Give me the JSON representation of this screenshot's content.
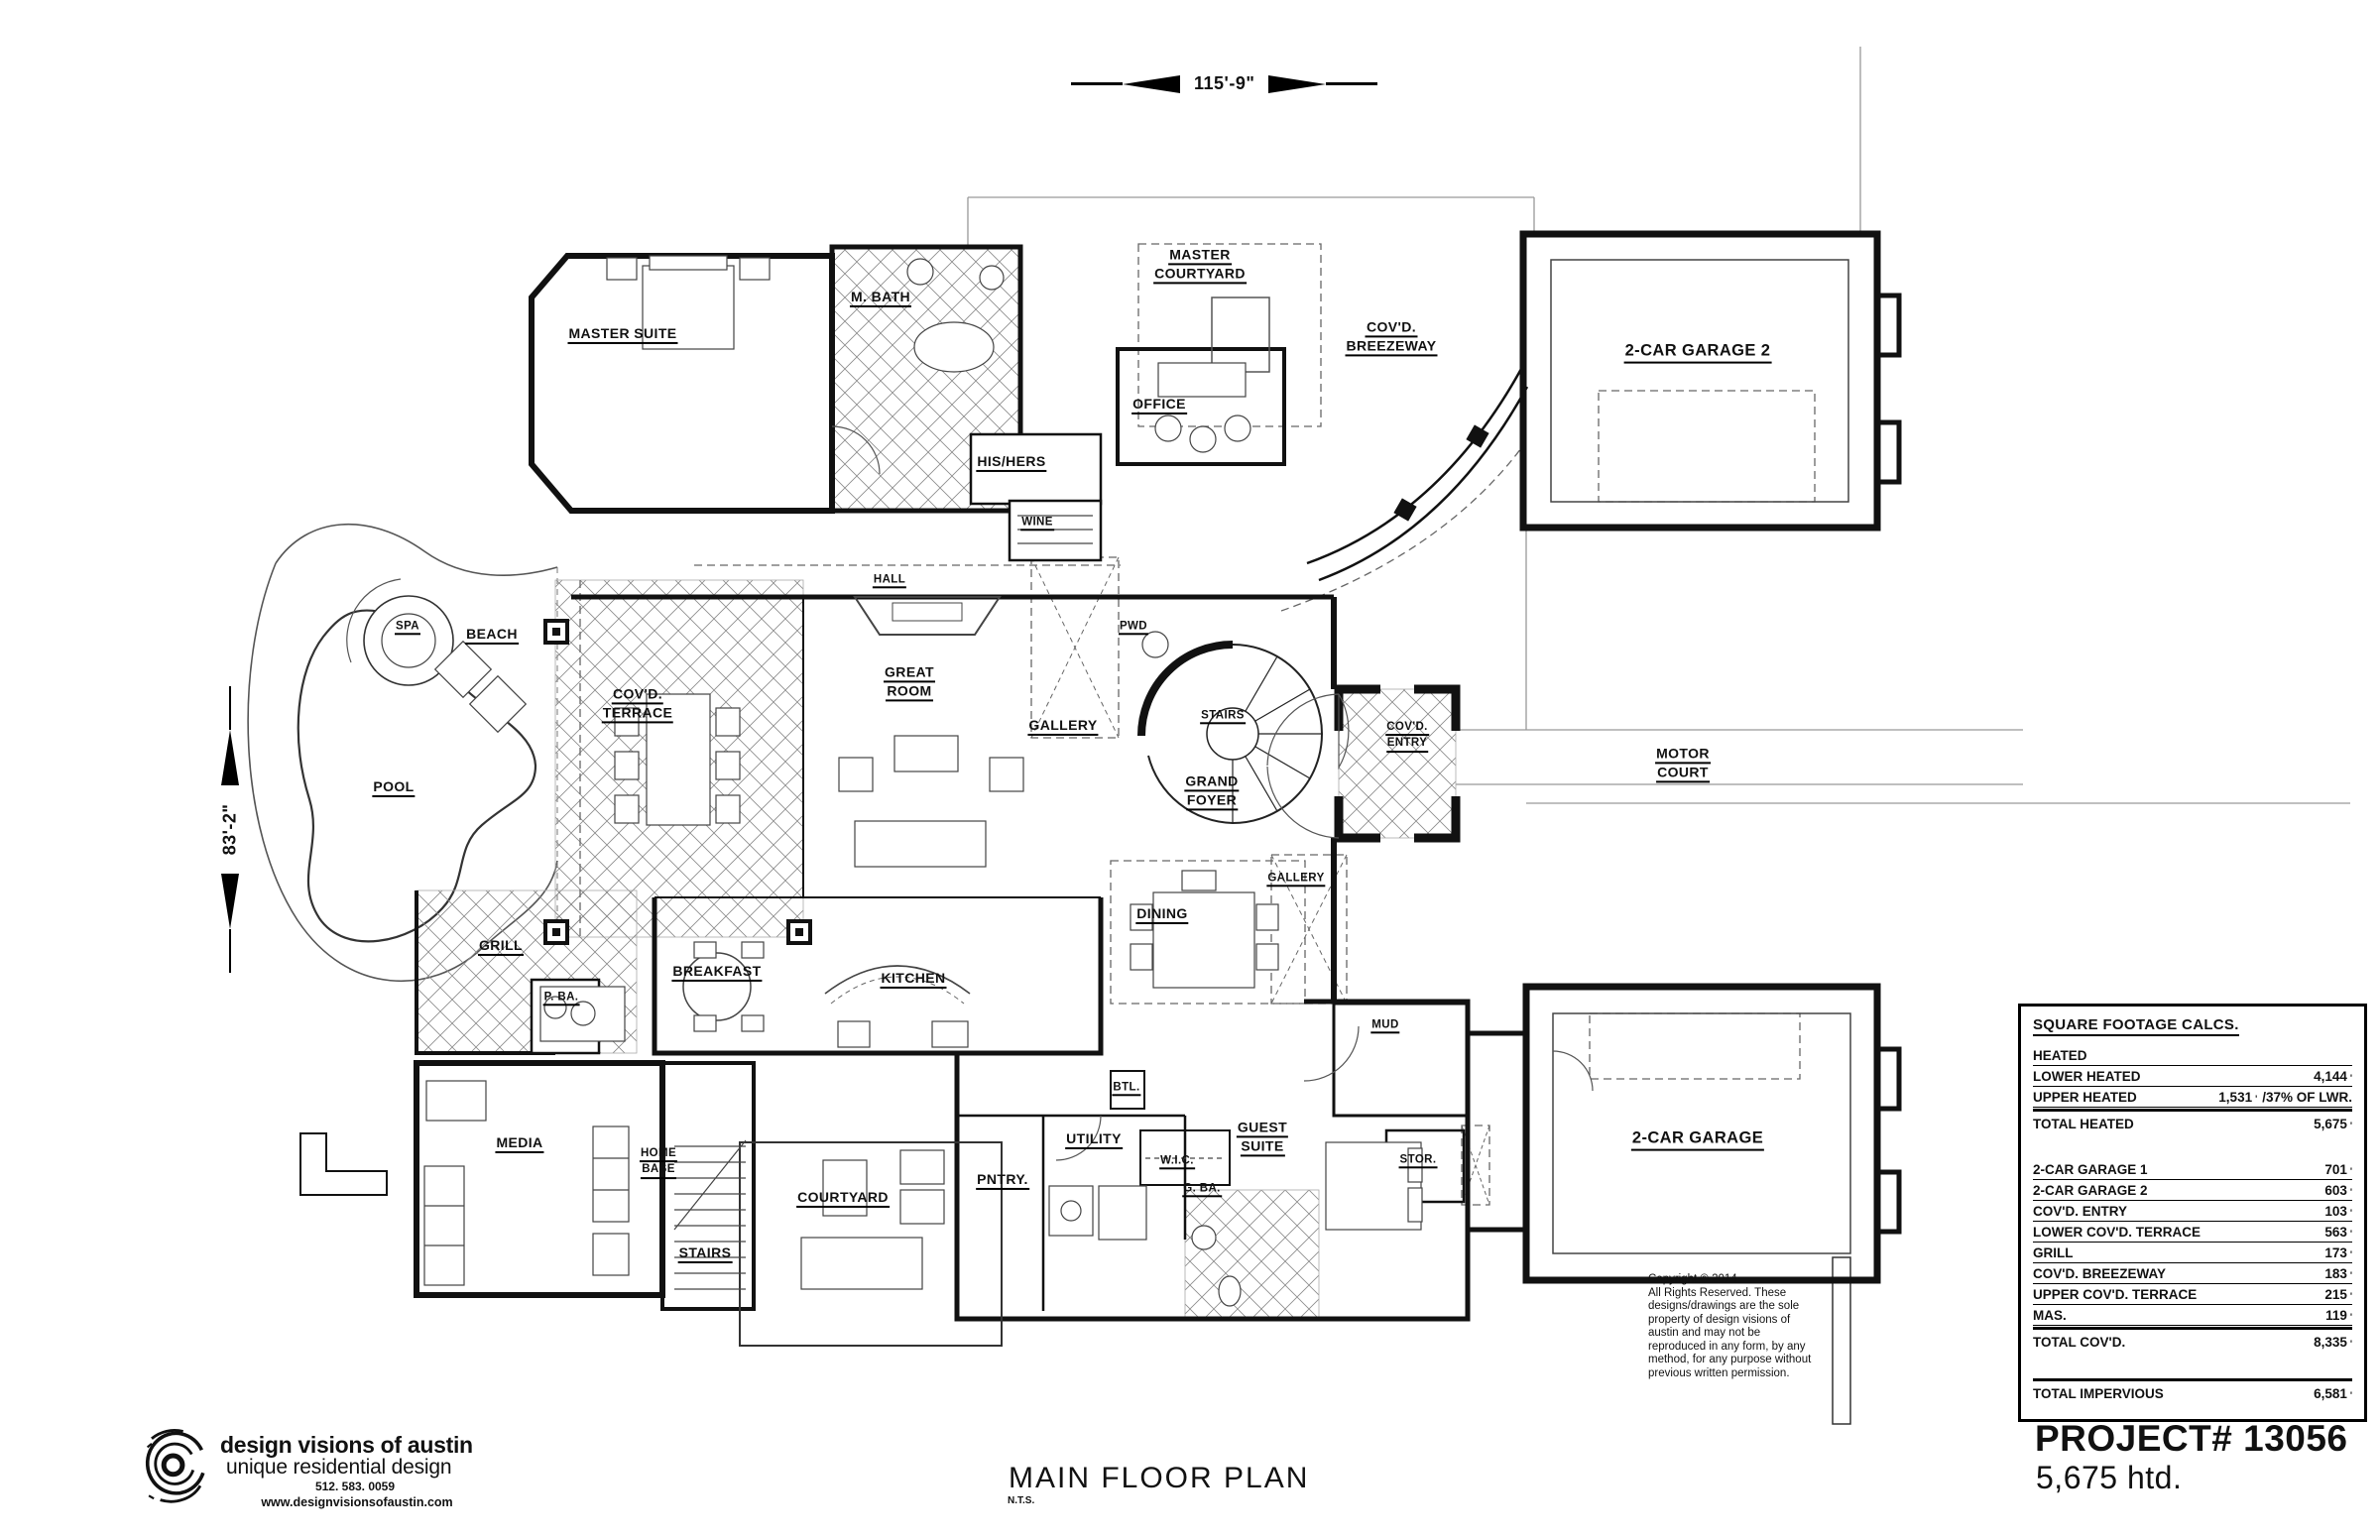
{
  "dimensions": {
    "width_label": "115'-9\"",
    "height_label": "83'-2\""
  },
  "title_block": {
    "title": "MAIN FLOOR PLAN",
    "scale_note": "N.T.S."
  },
  "project": {
    "number_label": "PROJECT# 13056",
    "area_label": "5,675 htd."
  },
  "firm": {
    "logo_icon": "swirl-logo",
    "name": "design visions of austin",
    "tagline": "unique residential design",
    "phone": "512. 583. 0059",
    "website": "www.designvisionsofaustin.com"
  },
  "copyright": {
    "text": "Copyright  ©  2014\nAll Rights Reserved. These\ndesigns/drawings are the sole\nproperty of design visions of\naustin and may not be\nreproduced in any form, by any\nmethod, for any purpose without\nprevious written permission."
  },
  "sqft_table": {
    "title": "SQUARE FOOTAGE CALCS.",
    "section_heated_label": "HEATED",
    "rows_heated": [
      {
        "label": "LOWER HEATED",
        "value": "4,144",
        "unit": "'"
      },
      {
        "label": "UPPER HEATED",
        "value": "1,531",
        "unit": "'",
        "note": "/37% OF LWR."
      }
    ],
    "total_heated": {
      "label": "TOTAL HEATED",
      "value": "5,675",
      "unit": "'"
    },
    "rows_covered": [
      {
        "label": "2-CAR GARAGE 1",
        "value": "701",
        "unit": "'"
      },
      {
        "label": "2-CAR GARAGE 2",
        "value": "603",
        "unit": "'"
      },
      {
        "label": "COV'D. ENTRY",
        "value": "103",
        "unit": "'"
      },
      {
        "label": "LOWER COV'D. TERRACE",
        "value": "563",
        "unit": "'"
      },
      {
        "label": "GRILL",
        "value": "173",
        "unit": "'"
      },
      {
        "label": "COV'D. BREEZEWAY",
        "value": "183",
        "unit": "'"
      },
      {
        "label": "UPPER COV'D. TERRACE",
        "value": "215",
        "unit": "'"
      },
      {
        "label": "MAS.",
        "value": "119",
        "unit": "'"
      }
    ],
    "total_covered": {
      "label": "TOTAL COV'D.",
      "value": "8,335",
      "unit": "'"
    },
    "total_impervious": {
      "label": "TOTAL IMPERVIOUS",
      "value": "6,581",
      "unit": "'"
    }
  },
  "rooms": [
    {
      "id": "master-suite",
      "lines": [
        "MASTER SUITE"
      ]
    },
    {
      "id": "m-bath",
      "lines": [
        "M. BATH"
      ]
    },
    {
      "id": "his-hers",
      "lines": [
        "HIS/HERS"
      ]
    },
    {
      "id": "wine",
      "lines": [
        "WINE"
      ]
    },
    {
      "id": "office",
      "lines": [
        "OFFICE"
      ]
    },
    {
      "id": "master-courtyard",
      "lines": [
        "MASTER",
        "COURTYARD"
      ]
    },
    {
      "id": "covd-breezeway",
      "lines": [
        "COV'D.",
        "BREEZEWAY"
      ]
    },
    {
      "id": "garage-2",
      "lines": [
        "2-CAR GARAGE 2"
      ]
    },
    {
      "id": "motor-court",
      "lines": [
        "MOTOR",
        "COURT"
      ]
    },
    {
      "id": "hall",
      "lines": [
        "HALL"
      ]
    },
    {
      "id": "great-room",
      "lines": [
        "GREAT",
        "ROOM"
      ]
    },
    {
      "id": "gallery-1",
      "lines": [
        "GALLERY"
      ]
    },
    {
      "id": "pwd",
      "lines": [
        "PWD"
      ]
    },
    {
      "id": "stairs-main",
      "lines": [
        "STAIRS"
      ]
    },
    {
      "id": "grand-foyer",
      "lines": [
        "GRAND",
        "FOYER"
      ]
    },
    {
      "id": "covd-entry",
      "lines": [
        "COV'D.",
        "ENTRY"
      ]
    },
    {
      "id": "gallery-2",
      "lines": [
        "GALLERY"
      ]
    },
    {
      "id": "dining",
      "lines": [
        "DINING"
      ]
    },
    {
      "id": "spa",
      "lines": [
        "SPA"
      ]
    },
    {
      "id": "beach",
      "lines": [
        "BEACH"
      ]
    },
    {
      "id": "pool",
      "lines": [
        "POOL"
      ]
    },
    {
      "id": "covd-terrace",
      "lines": [
        "COV'D.",
        "TERRACE"
      ]
    },
    {
      "id": "grill",
      "lines": [
        "GRILL"
      ]
    },
    {
      "id": "p-ba",
      "lines": [
        "P. BA."
      ]
    },
    {
      "id": "breakfast",
      "lines": [
        "BREAKFAST"
      ]
    },
    {
      "id": "kitchen",
      "lines": [
        "KITCHEN"
      ]
    },
    {
      "id": "media",
      "lines": [
        "MEDIA"
      ]
    },
    {
      "id": "home-base",
      "lines": [
        "HOME",
        "BASE"
      ]
    },
    {
      "id": "stairs-lower",
      "lines": [
        "STAIRS"
      ]
    },
    {
      "id": "courtyard",
      "lines": [
        "COURTYARD"
      ]
    },
    {
      "id": "pntry",
      "lines": [
        "PNTRY."
      ]
    },
    {
      "id": "utility",
      "lines": [
        "UTILITY"
      ]
    },
    {
      "id": "wic",
      "lines": [
        "W.I.C."
      ]
    },
    {
      "id": "g-ba",
      "lines": [
        "G. BA."
      ]
    },
    {
      "id": "guest-suite",
      "lines": [
        "GUEST",
        "SUITE"
      ]
    },
    {
      "id": "mud",
      "lines": [
        "MUD"
      ]
    },
    {
      "id": "stor",
      "lines": [
        "STOR."
      ]
    },
    {
      "id": "garage-1",
      "lines": [
        "2-CAR GARAGE"
      ]
    },
    {
      "id": "btl",
      "lines": [
        "BTL."
      ]
    }
  ],
  "colors": {
    "line": "#111111",
    "light_line": "#999999",
    "hatch": "#8a8a8a",
    "background": "#ffffff"
  }
}
